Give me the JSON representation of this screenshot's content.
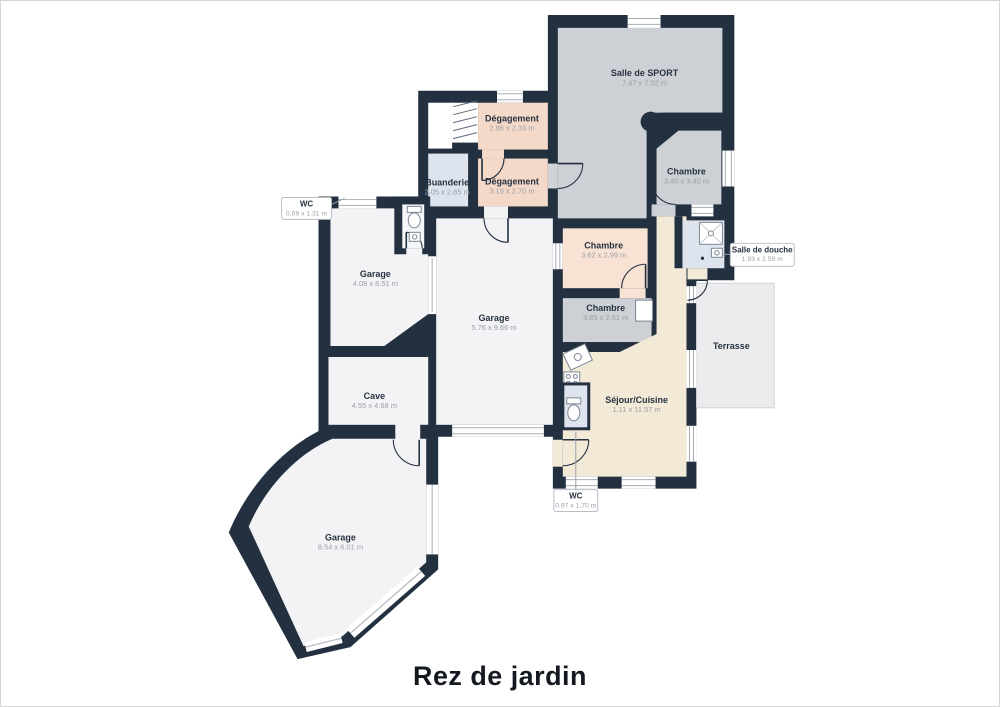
{
  "title": "Rez de jardin",
  "rooms": [
    {
      "name": "Salle de SPORT",
      "dims": "7.47 x 7.02 m"
    },
    {
      "name": "Dégagement",
      "dims": "2.96 x 2.33 m"
    },
    {
      "name": "Buanderie",
      "dims": "2.05 x 2.65 m"
    },
    {
      "name": "Dégagement",
      "dims": "3.19 x 2.70 m"
    },
    {
      "name": "Chambre",
      "dims": "3.40 x 3.40 m"
    },
    {
      "name": "Chambre",
      "dims": "3.62 x 2.99 m"
    },
    {
      "name": "Chambre",
      "dims": "3.85 x 2.51 m"
    },
    {
      "name": "Garage",
      "dims": "4.08 x 6.51 m"
    },
    {
      "name": "Garage",
      "dims": "5.76 x 9.66 m"
    },
    {
      "name": "Cave",
      "dims": "4.55 x 4.68 m"
    },
    {
      "name": "Séjour/Cuisine",
      "dims": "1.11 x 11.57 m"
    },
    {
      "name": "Garage",
      "dims": "8.54 x 6.01 m"
    },
    {
      "name": "Terrasse",
      "dims": ""
    }
  ],
  "callouts": [
    {
      "name": "WC",
      "dims": "0.69 x 1.31 m"
    },
    {
      "name": "Salle de douche",
      "dims": "1.93 x 2.59 m"
    },
    {
      "name": "WC",
      "dims": "0.97 x 1.70 m"
    }
  ],
  "colors": {
    "wall": "#233040",
    "room_gray": "#cdd1d6",
    "room_pink": "#f4d8c8",
    "room_peach": "#f8e2d4",
    "room_blue": "#dde4ee",
    "room_cream": "#f2ead7",
    "room_white": "#f3f3f5",
    "terrace": "#ececee",
    "label_text": "#273240",
    "dims_text": "#9aa0a8"
  }
}
